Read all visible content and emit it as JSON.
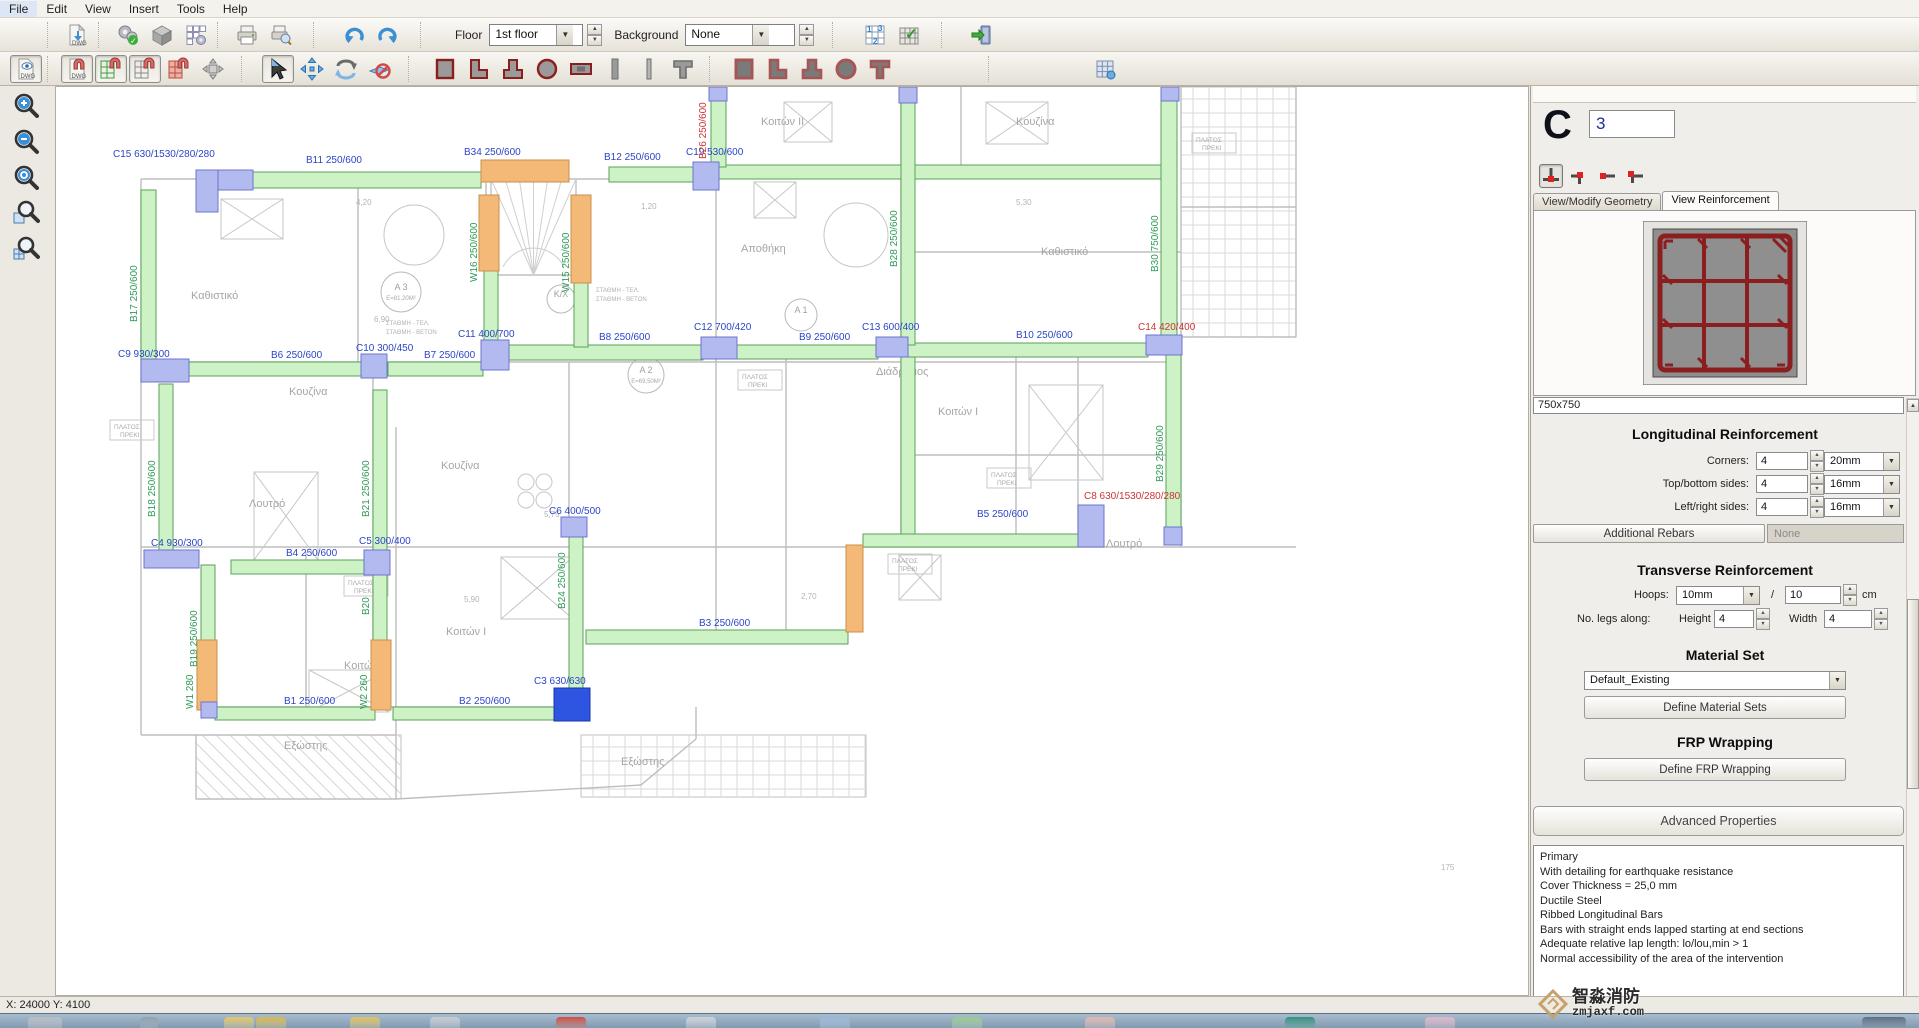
{
  "menu": {
    "items": [
      "File",
      "Edit",
      "View",
      "Insert",
      "Tools",
      "Help"
    ]
  },
  "toolbar1": {
    "floor_label": "Floor",
    "floor_value": "1st floor",
    "background_label": "Background",
    "background_value": "None",
    "icons": [
      "save-icon",
      "dwg-import-icon",
      "settings-check-icon",
      "cube-icon",
      "grid-gear-icon",
      "print-icon",
      "print-preview-icon",
      "undo-icon",
      "redo-icon",
      "grid-numbers-icon",
      "grid-check-icon",
      "exit-icon"
    ]
  },
  "toolbar2": {
    "icons": [
      "dwg-eye-icon",
      "dwg-magnet-icon",
      "grid-snap-green-icon",
      "grid-snap-icon",
      "grid-snap-red-icon",
      "move-grid-icon",
      "select-cursor-icon",
      "move-tool-icon",
      "rotate-tool-icon",
      "delete-tool-icon",
      "rect-section-icon",
      "l-section-icon",
      "t-section-icon",
      "circle-section-icon",
      "wall-section-icon",
      "bar-section-icon",
      "bar2-section-icon",
      "tee-section-icon",
      "rect-filled-icon",
      "l-filled-icon",
      "t-filled-icon",
      "circle-filled-icon",
      "tee-filled-icon",
      "grid-small-icon"
    ]
  },
  "zoombar": {
    "icons": [
      "zoom-in-icon",
      "zoom-out-icon",
      "zoom-extents-icon",
      "zoom-window-icon",
      "zoom-grid-icon"
    ]
  },
  "panel": {
    "section_letter": "C",
    "section_number": "3",
    "tabs": [
      {
        "label": "View/Modify Geometry"
      },
      {
        "label": "View Reinforcement"
      }
    ],
    "section_size": "750x750",
    "longitudinal": {
      "title": "Longitudinal Reinforcement",
      "rows": [
        {
          "label": "Corners:",
          "count": "4",
          "dia": "20mm"
        },
        {
          "label": "Top/bottom sides:",
          "count": "4",
          "dia": "16mm"
        },
        {
          "label": "Left/right sides:",
          "count": "4",
          "dia": "16mm"
        }
      ],
      "additional_btn": "Additional Rebars",
      "additional_value": "None"
    },
    "transverse": {
      "title": "Transverse Reinforcement",
      "hoops_label": "Hoops:",
      "hoops_dia": "10mm",
      "slash": "/",
      "spacing": "10",
      "unit": "cm",
      "legs_label": "No. legs along:",
      "height_label": "Height",
      "height": "4",
      "width_label": "Width",
      "width": "4"
    },
    "material": {
      "title": "Material Set",
      "value": "Default_Existing",
      "btn": "Define Material Sets"
    },
    "frp": {
      "title": "FRP Wrapping",
      "btn": "Define FRP Wrapping"
    },
    "advanced": {
      "btn": "Advanced Properties",
      "lines": [
        "Primary",
        "With detailing for earthquake resistance",
        "Cover Thickness = 25,0 mm",
        "Ductile Steel",
        "Ribbed Longitudinal Bars",
        "Bars with straight ends lapped starting at end sections",
        "Adequate relative lap length: lo/lou,min > 1",
        "Normal accessibility of the area of the intervention"
      ]
    }
  },
  "statusbar": {
    "coords": "X: 24000  Y: 4100"
  },
  "watermark": {
    "line1": "智淼消防",
    "line2": "zmjaxf.com"
  },
  "colors": {
    "beam": "#cdf2c6",
    "beam_border": "#5aa25a",
    "column": "#b3baf0",
    "column_border": "#6b74cc",
    "wall": "#f4b877",
    "wall_border": "#c98f4e",
    "selected": "#2e55e2",
    "label_blue": "#2b45c8",
    "label_green": "#2e9b57",
    "label_red": "#cc3333",
    "rebar": "#8b1f1f"
  },
  "plan": {
    "beams": [
      [
        177,
        85,
        248,
        16
      ],
      [
        553,
        80,
        84,
        15
      ],
      [
        663,
        78,
        447,
        14
      ],
      [
        85,
        103,
        15,
        172
      ],
      [
        103,
        297,
        14,
        172
      ],
      [
        145,
        478,
        14,
        140
      ],
      [
        317,
        303,
        14,
        162
      ],
      [
        317,
        465,
        14,
        92
      ],
      [
        120,
        275,
        187,
        14
      ],
      [
        332,
        275,
        95,
        14
      ],
      [
        453,
        258,
        194,
        15
      ],
      [
        680,
        258,
        142,
        14
      ],
      [
        850,
        256,
        242,
        14
      ],
      [
        655,
        5,
        15,
        75
      ],
      [
        845,
        5,
        14,
        253
      ],
      [
        1105,
        3,
        16,
        255
      ],
      [
        1110,
        258,
        15,
        190
      ],
      [
        175,
        473,
        137,
        14
      ],
      [
        159,
        620,
        160,
        13
      ],
      [
        337,
        620,
        163,
        13
      ],
      [
        513,
        448,
        14,
        157
      ],
      [
        530,
        543,
        262,
        14
      ],
      [
        807,
        447,
        215,
        13
      ],
      [
        428,
        182,
        14,
        78
      ],
      [
        518,
        195,
        14,
        65
      ],
      [
        845,
        270,
        14,
        177
      ]
    ],
    "walls": [
      [
        425,
        73,
        88,
        22
      ],
      [
        423,
        108,
        20,
        76
      ],
      [
        515,
        108,
        20,
        88
      ],
      [
        141,
        553,
        20,
        70
      ],
      [
        315,
        553,
        20,
        70
      ],
      [
        790,
        458,
        17,
        87
      ]
    ],
    "columns": [
      [
        140,
        83,
        57,
        20
      ],
      [
        140,
        83,
        22,
        42
      ],
      [
        637,
        75,
        26,
        28
      ],
      [
        85,
        272,
        48,
        23
      ],
      [
        305,
        267,
        26,
        24
      ],
      [
        425,
        253,
        28,
        30
      ],
      [
        645,
        250,
        36,
        22
      ],
      [
        820,
        250,
        32,
        20
      ],
      [
        1090,
        248,
        36,
        20
      ],
      [
        88,
        463,
        55,
        18
      ],
      [
        308,
        463,
        26,
        25
      ],
      [
        505,
        430,
        26,
        20
      ],
      [
        1022,
        418,
        26,
        42
      ],
      [
        843,
        0,
        18,
        16
      ],
      [
        1105,
        0,
        18,
        14
      ],
      [
        653,
        0,
        18,
        14
      ],
      [
        1108,
        440,
        18,
        18
      ],
      [
        145,
        615,
        16,
        16
      ]
    ],
    "selected": [
      498,
      601,
      36,
      33
    ],
    "labels": [
      {
        "t": "C15  630/1530/280/280",
        "x": 57,
        "y": 70,
        "c": "blue"
      },
      {
        "t": "B11  250/600",
        "x": 250,
        "y": 76,
        "c": "blue"
      },
      {
        "t": "B34  250/600",
        "x": 408,
        "y": 68,
        "c": "blue"
      },
      {
        "t": "B12  250/600",
        "x": 548,
        "y": 73,
        "c": "blue"
      },
      {
        "t": "C19  530/600",
        "x": 630,
        "y": 68,
        "c": "blue"
      },
      {
        "t": "B26 250/600",
        "x": 650,
        "y": 72,
        "c": "red",
        "r": -90
      },
      {
        "t": "B28 250/600",
        "x": 841,
        "y": 180,
        "c": "green",
        "r": -90
      },
      {
        "t": "B30 750/600",
        "x": 1102,
        "y": 185,
        "c": "green",
        "r": -90
      },
      {
        "t": "B29 250/600",
        "x": 1107,
        "y": 395,
        "c": "green",
        "r": -90
      },
      {
        "t": "B17 250/600",
        "x": 81,
        "y": 235,
        "c": "green",
        "r": -90
      },
      {
        "t": "B18 250/600",
        "x": 99,
        "y": 430,
        "c": "green",
        "r": -90
      },
      {
        "t": "B19 250/600",
        "x": 141,
        "y": 580,
        "c": "green",
        "r": -90
      },
      {
        "t": "W1 280",
        "x": 137,
        "y": 622,
        "c": "green",
        "r": -90
      },
      {
        "t": "B21 250/600",
        "x": 313,
        "y": 430,
        "c": "green",
        "r": -90
      },
      {
        "t": "B20",
        "x": 313,
        "y": 528,
        "c": "green",
        "r": -90
      },
      {
        "t": "W2 260",
        "x": 311,
        "y": 622,
        "c": "green",
        "r": -90
      },
      {
        "t": "W16 250/600",
        "x": 421,
        "y": 195,
        "c": "green",
        "r": -90
      },
      {
        "t": "W15 250/600",
        "x": 513,
        "y": 205,
        "c": "green",
        "r": -90
      },
      {
        "t": "C9  930/300",
        "x": 62,
        "y": 270,
        "c": "blue"
      },
      {
        "t": "B6  250/600",
        "x": 215,
        "y": 271,
        "c": "blue"
      },
      {
        "t": "C10  300/450",
        "x": 300,
        "y": 264,
        "c": "blue"
      },
      {
        "t": "B7  250/600",
        "x": 368,
        "y": 271,
        "c": "blue"
      },
      {
        "t": "C11  400/700",
        "x": 402,
        "y": 250,
        "c": "blue"
      },
      {
        "t": "B8  250/600",
        "x": 543,
        "y": 253,
        "c": "blue"
      },
      {
        "t": "C12  700/420",
        "x": 638,
        "y": 243,
        "c": "blue"
      },
      {
        "t": "B9  250/600",
        "x": 743,
        "y": 253,
        "c": "blue"
      },
      {
        "t": "C13  600/400",
        "x": 806,
        "y": 243,
        "c": "blue"
      },
      {
        "t": "B10  250/600",
        "x": 960,
        "y": 251,
        "c": "blue"
      },
      {
        "t": "C14  420/400",
        "x": 1082,
        "y": 243,
        "c": "red"
      },
      {
        "t": "C4  930/300",
        "x": 95,
        "y": 459,
        "c": "blue"
      },
      {
        "t": "B4  250/600",
        "x": 230,
        "y": 469,
        "c": "blue"
      },
      {
        "t": "C5  300/400",
        "x": 303,
        "y": 457,
        "c": "blue"
      },
      {
        "t": "C6  400/500",
        "x": 493,
        "y": 427,
        "c": "blue"
      },
      {
        "t": "B24 250/600",
        "x": 509,
        "y": 522,
        "c": "green",
        "r": -90
      },
      {
        "t": "C3  630/630",
        "x": 478,
        "y": 597,
        "c": "blue"
      },
      {
        "t": "B1  250/600",
        "x": 228,
        "y": 617,
        "c": "blue"
      },
      {
        "t": "B2  250/600",
        "x": 403,
        "y": 617,
        "c": "blue"
      },
      {
        "t": "B3  250/600",
        "x": 643,
        "y": 539,
        "c": "blue"
      },
      {
        "t": "B5  250/600",
        "x": 921,
        "y": 430,
        "c": "blue"
      },
      {
        "t": "C8  630/1530/280/280",
        "x": 1028,
        "y": 412,
        "c": "red"
      }
    ],
    "bg": {
      "vlines": [
        [
          85,
          92,
          648
        ],
        [
          302,
          92,
          275
        ],
        [
          430,
          92,
          188
        ],
        [
          660,
          0,
          258
        ],
        [
          845,
          0,
          258
        ],
        [
          1125,
          0,
          460
        ],
        [
          1240,
          0,
          250
        ],
        [
          317,
          275,
          620
        ],
        [
          513,
          275,
          448
        ],
        [
          660,
          258,
          543
        ],
        [
          845,
          258,
          460
        ],
        [
          1022,
          258,
          460
        ],
        [
          435,
          92,
          195
        ],
        [
          520,
          92,
          195
        ],
        [
          250,
          465,
          620
        ],
        [
          730,
          258,
          543
        ],
        [
          960,
          258,
          460
        ],
        [
          340,
          648,
          340
        ],
        [
          905,
          0,
          92
        ]
      ],
      "hlines": [
        [
          92,
          85,
          660
        ],
        [
          188,
          430,
          520
        ],
        [
          275,
          85,
          1125
        ],
        [
          460,
          85,
          1240
        ],
        [
          620,
          140,
          530
        ],
        [
          120,
          1125,
          1240
        ],
        [
          250,
          1125,
          1240
        ],
        [
          368,
          845,
          1125
        ],
        [
          165,
          845,
          1125
        ],
        [
          545,
          660,
          790
        ],
        [
          648,
          85,
          340
        ]
      ],
      "diag": [
        [
          340,
          712,
          585,
          698
        ],
        [
          585,
          698,
          640,
          652
        ],
        [
          140,
          648,
          140,
          712
        ],
        [
          140,
          712,
          340,
          712
        ],
        [
          340,
          648,
          340,
          712
        ],
        [
          640,
          652,
          640,
          620
        ]
      ],
      "xboxes": [
        [
          165,
          112,
          62,
          40
        ],
        [
          198,
          385,
          64,
          88
        ],
        [
          973,
          298,
          74,
          95
        ],
        [
          253,
          583,
          80,
          42
        ],
        [
          930,
          15,
          62,
          42
        ],
        [
          728,
          15,
          48,
          40
        ],
        [
          445,
          470,
          72,
          62
        ],
        [
          698,
          95,
          42,
          36
        ],
        [
          843,
          468,
          42,
          45
        ]
      ],
      "circles": [
        [
          358,
          148,
          30
        ],
        [
          800,
          148,
          32
        ],
        [
          470,
          395,
          8
        ],
        [
          488,
          395,
          8
        ],
        [
          470,
          413,
          8
        ],
        [
          488,
          413,
          8
        ]
      ],
      "area_tags": [
        {
          "x": 345,
          "y": 205,
          "r": 20,
          "l1": "A 3",
          "l2": "E=81,20M²"
        },
        {
          "x": 745,
          "y": 228,
          "r": 16,
          "l1": "A 1",
          "l2": ""
        },
        {
          "x": 590,
          "y": 288,
          "r": 18,
          "l1": "A 2",
          "l2": "E=69,50M²"
        },
        {
          "x": 505,
          "y": 212,
          "r": 14,
          "l1": "Κ/Χ",
          "l2": ""
        }
      ],
      "labels": [
        [
          135,
          212,
          "Καθιστικό"
        ],
        [
          233,
          308,
          "Κουζίνα"
        ],
        [
          385,
          382,
          "Κουζίνα"
        ],
        [
          960,
          38,
          "Κουζίνα"
        ],
        [
          705,
          38,
          "Κοιτών II"
        ],
        [
          882,
          328,
          "Κοιτών I"
        ],
        [
          390,
          548,
          "Κοιτών I"
        ],
        [
          288,
          582,
          "Κοιτών II"
        ],
        [
          985,
          168,
          "Καθιστικό"
        ],
        [
          193,
          420,
          "Λουτρό"
        ],
        [
          1050,
          460,
          "Λουτρό"
        ],
        [
          820,
          288,
          "Διάδρομος"
        ],
        [
          685,
          165,
          "Αποθήκη"
        ],
        [
          228,
          662,
          "Εξώστης"
        ],
        [
          565,
          678,
          "Εξώστης"
        ]
      ],
      "mini_label": [
        "ΠΛΑΤΟΣ",
        "ΠΡΕΚΙ"
      ],
      "minis": [
        [
          58,
          342
        ],
        [
          292,
          498
        ],
        [
          686,
          292
        ],
        [
          935,
          390
        ],
        [
          836,
          476
        ],
        [
          1140,
          55
        ]
      ],
      "dims": [
        [
          300,
          118,
          "4,20"
        ],
        [
          585,
          122,
          "1,20"
        ],
        [
          488,
          430,
          "5,75"
        ],
        [
          408,
          515,
          "5,90"
        ],
        [
          745,
          512,
          "2,70"
        ],
        [
          1385,
          783,
          "175"
        ],
        [
          318,
          235,
          "6,90"
        ],
        [
          960,
          118,
          "5,30"
        ]
      ],
      "stamps": [
        [
          540,
          205,
          "ΣΤΑΘΜΗ - ΤΕΛ."
        ],
        [
          540,
          214,
          "ΣΤΑΘΜΗ - ΒΕΤΟΝ"
        ],
        [
          330,
          238,
          "ΣΤΑΘΜΗ - ΤΕΛ."
        ],
        [
          330,
          247,
          "ΣΤΑΘΜΗ - ΒΕΤΟΝ"
        ]
      ],
      "stair": {
        "x": 435,
        "y": 92,
        "w": 85,
        "h": 96
      },
      "hatch_diag": [
        [
          140,
          648,
          205,
          64
        ]
      ],
      "hatch_grid": [
        [
          525,
          648,
          285,
          62
        ],
        [
          1125,
          0,
          115,
          250
        ]
      ]
    }
  },
  "taskbar": {
    "icons": [
      {
        "name": "start-orb",
        "x": 28,
        "w": 34,
        "c": "#b9bec4"
      },
      {
        "name": "pinned-dots",
        "x": 140,
        "w": 18,
        "c": "#93a0ac"
      },
      {
        "name": "folder-1",
        "x": 224,
        "w": 30,
        "c": "#e6c767"
      },
      {
        "name": "folder-2",
        "x": 256,
        "w": 30,
        "c": "#d9b94f"
      },
      {
        "name": "folder-3",
        "x": 350,
        "w": 30,
        "c": "#e2c25c"
      },
      {
        "name": "app-gray",
        "x": 430,
        "w": 30,
        "c": "#c6ccd2"
      },
      {
        "name": "app-red",
        "x": 556,
        "w": 30,
        "c": "#d24a3a"
      },
      {
        "name": "app-window",
        "x": 686,
        "w": 30,
        "c": "#cdd3d8"
      },
      {
        "name": "app-blue",
        "x": 820,
        "w": 30,
        "c": "#9db8d8"
      },
      {
        "name": "app-green",
        "x": 952,
        "w": 30,
        "c": "#9ccb90"
      },
      {
        "name": "app-pink",
        "x": 1085,
        "w": 30,
        "c": "#e3b7ad"
      },
      {
        "name": "app-teal",
        "x": 1285,
        "w": 30,
        "c": "#2f8f7a"
      },
      {
        "name": "app-rose",
        "x": 1425,
        "w": 30,
        "c": "#e0b9c9"
      },
      {
        "name": "tray",
        "x": 1862,
        "w": 44,
        "c": "#5a6b7d"
      }
    ]
  }
}
